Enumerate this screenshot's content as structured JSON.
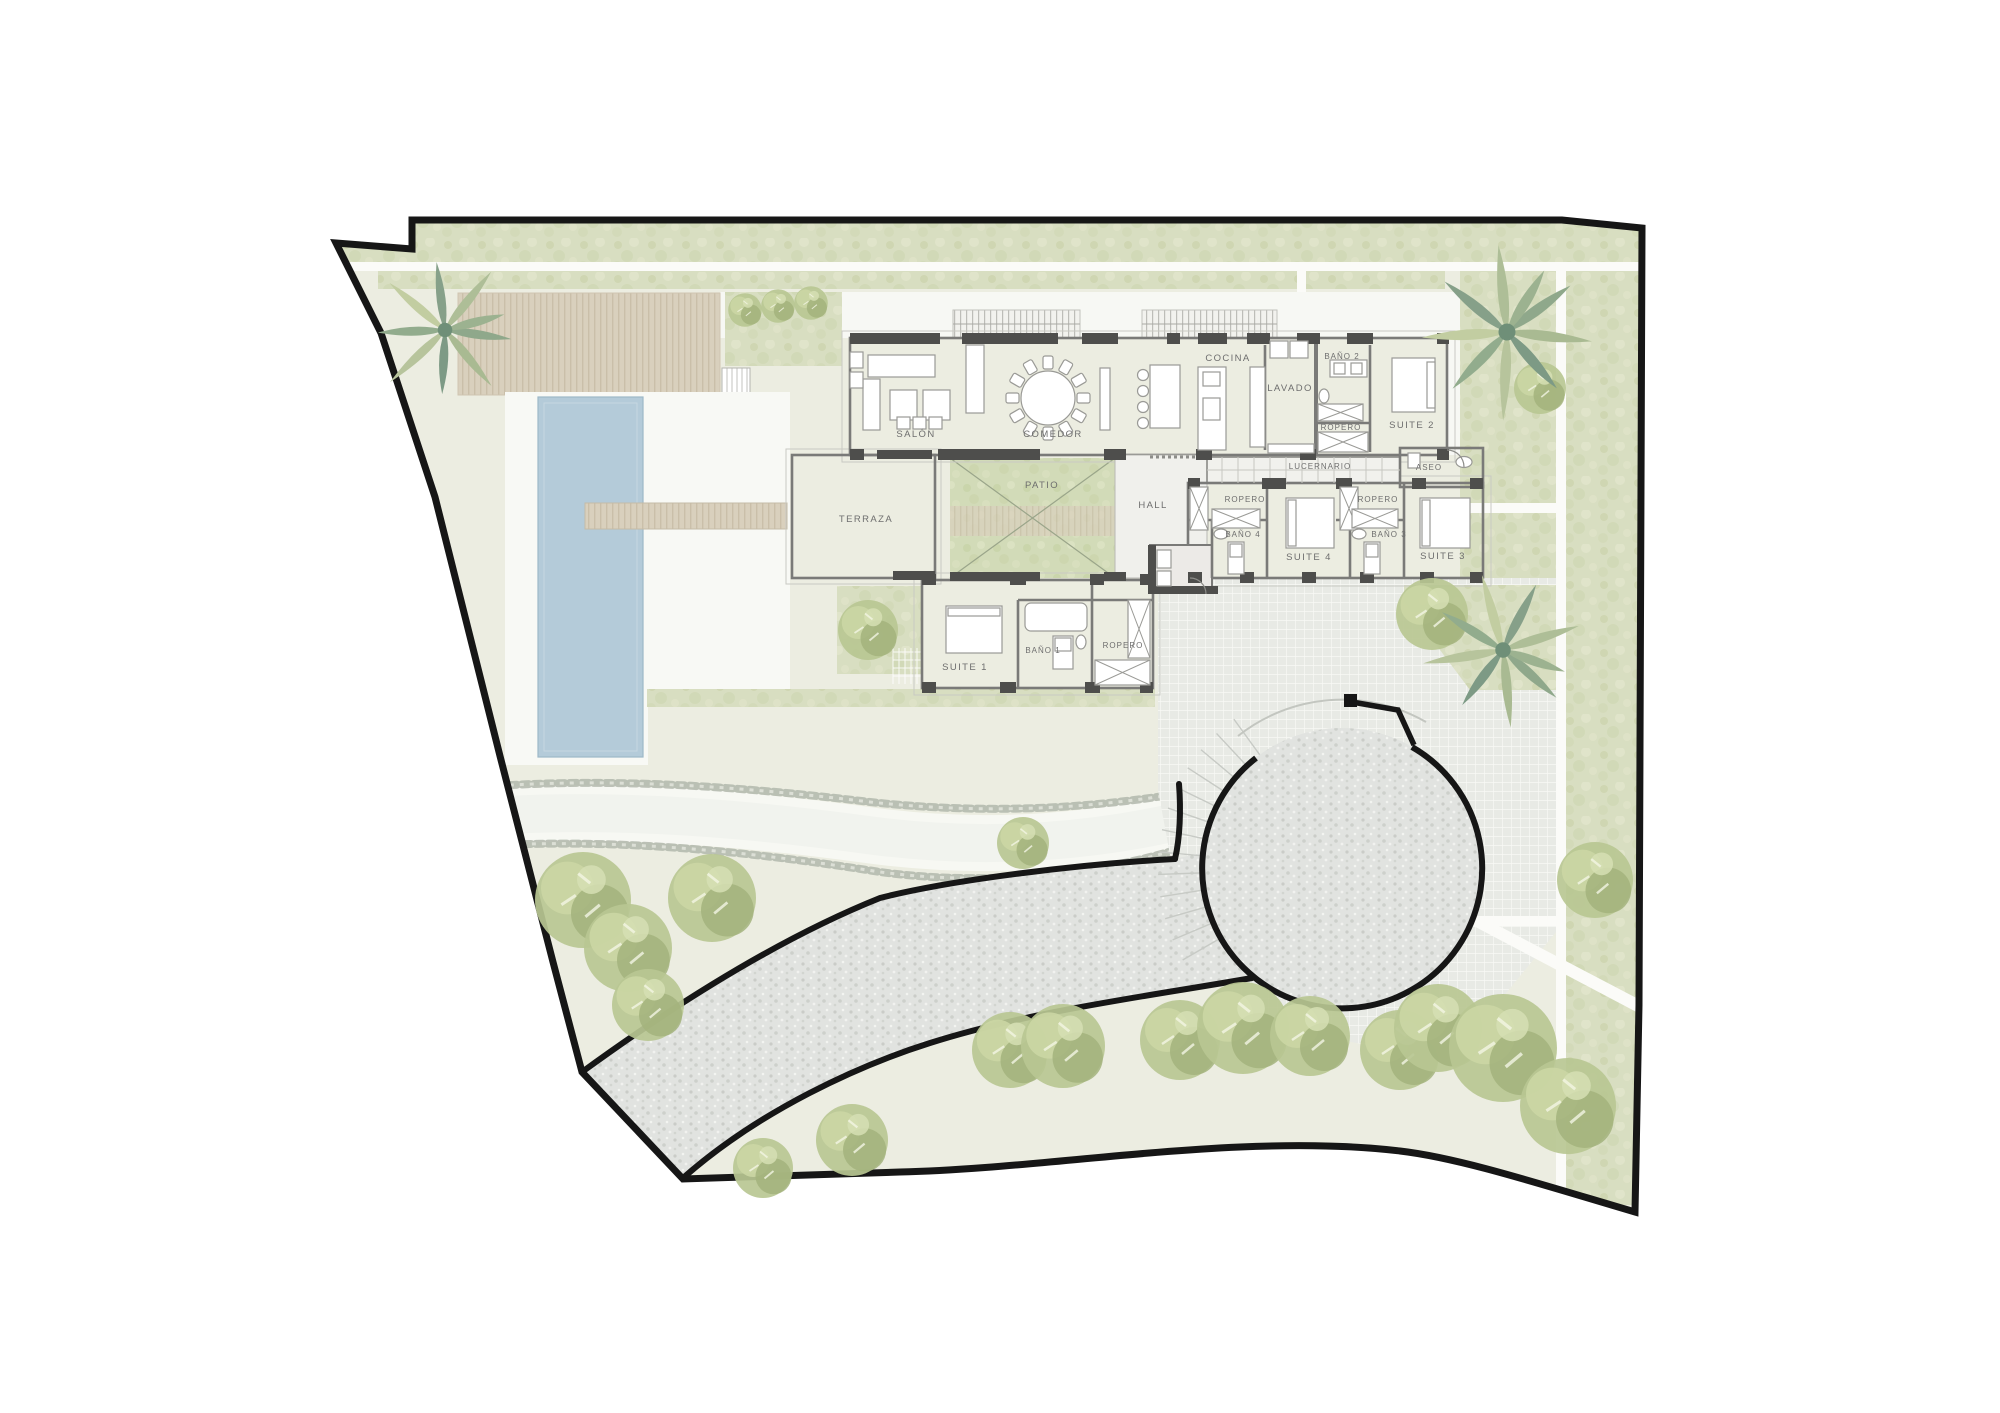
{
  "plan": {
    "type": "villa-site-and-floor-plan",
    "language": "es"
  },
  "rooms": {
    "salon": "SALÓN",
    "comedor": "COMEDOR",
    "cocina": "COCINA",
    "lavado": "LAVADO",
    "bano2": "BAÑO 2",
    "suite2": "SUITE 2",
    "ropero_suite2": "ROPERO",
    "lucernario": "LUCERNARIO",
    "aseo": "ASEO",
    "patio": "PATIO",
    "terraza": "TERRAZA",
    "hall": "HALL",
    "ropero_suite4": "ROPERO",
    "bano4": "BAÑO 4",
    "suite4": "SUITE 4",
    "ropero_suite3": "ROPERO",
    "bano3": "BAÑO 3",
    "suite3": "SUITE 3",
    "suite1": "SUITE 1",
    "bano1": "BAÑO 1",
    "ropero_suite1": "ROPERO"
  },
  "colors": {
    "boundary": "#161616",
    "lawn": "#ecede1",
    "hedge": "#d8dec1",
    "patio_green": "#d2dbb8",
    "pool_water": "#b4cbd9",
    "deck": "#d9d0bd",
    "drive": "#e1e3e0",
    "plaza": "#e8eae5",
    "path_white": "#fbfbf8",
    "room_fill": "#eaeae7",
    "wall": "#7a7a78",
    "pier": "#4e4e4c",
    "label": "#6e6e6e",
    "stream_stone": "#b2b7ac",
    "tree_green": "#b9c792",
    "palm_green": "#8fa88b"
  }
}
